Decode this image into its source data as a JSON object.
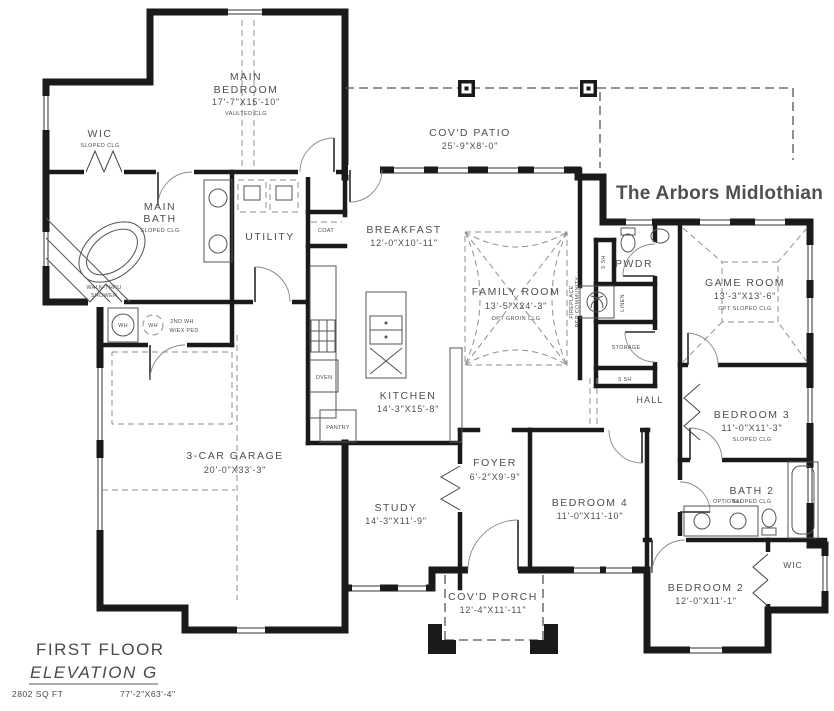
{
  "title": "The Arbors Midlothian",
  "colors": {
    "title": "#1d3d5e",
    "walls": "#1a1a1a",
    "labels": "#4f4f4f"
  },
  "footer": {
    "floor_label": "FIRST FLOOR",
    "elevation_label": "ELEVATION G",
    "area": "2802 SQ FT",
    "overall_dims": "77'-2\"X63'-4\""
  },
  "rooms": {
    "main_bedroom": {
      "name_line1": "MAIN",
      "name_line2": "BEDROOM",
      "dims": "17'-7\"X15'-10\"",
      "note": "VAULTED CLG"
    },
    "wic_main": {
      "name": "WIC",
      "note": "SLOPED CLG"
    },
    "main_bath": {
      "name_line1": "MAIN",
      "name_line2": "BATH",
      "note": "SLOPED CLG"
    },
    "covd_patio": {
      "name": "COV'D PATIO",
      "dims": "25'-9\"X8'-0\""
    },
    "breakfast": {
      "name": "BREAKFAST",
      "dims": "12'-0\"X10'-11\""
    },
    "family_room": {
      "name": "FAMILY ROOM",
      "dims": "13'-5\"X24'-3\"",
      "note": "OPT GROIN CLG"
    },
    "game_room": {
      "name": "GAME ROOM",
      "dims": "13'-3\"X13'-6\"",
      "note": "OPT SLOPED CLG"
    },
    "kitchen": {
      "name": "KITCHEN",
      "dims": "14'-3\"X15'-8\""
    },
    "utility": {
      "name": "UTILITY"
    },
    "pwdr": {
      "name": "PWDR"
    },
    "hall": {
      "name": "HALL"
    },
    "garage": {
      "name": "3-CAR GARAGE",
      "dims": "20'-0\"X33'-3\""
    },
    "study": {
      "name": "STUDY",
      "dims": "14'-3\"X11'-9\""
    },
    "foyer": {
      "name": "FOYER",
      "dims": "6'-2\"X9'-9\""
    },
    "bedroom4": {
      "name": "BEDROOM 4",
      "dims": "11'-0\"X11'-10\""
    },
    "bedroom3": {
      "name": "BEDROOM 3",
      "dims": "11'-0\"X11'-3\"",
      "note": "SLOPED CLG"
    },
    "bath2": {
      "name": "BATH 2",
      "note": "SLOPED CLG"
    },
    "bedroom2": {
      "name": "BEDROOM 2",
      "dims": "12'-0\"X11'-1\""
    },
    "wic_bedroom2": {
      "name": "WIC"
    },
    "covd_porch": {
      "name": "COV'D PORCH",
      "dims": "12'-4\"X11'-11\""
    }
  },
  "callouts": {
    "shower_line1": "WALK-THRU",
    "shower_line2": "SHOWER",
    "coat": "COAT",
    "oven": "OVEN",
    "pantry": "PANTRY",
    "linen": "LINEN",
    "storage": "STORAGE",
    "shelves_pwdr": "5 SH",
    "shelves_hall": "5 SH",
    "water_heater": "WH",
    "water_heater_2": "WH",
    "second_wh_line1": "2ND WH",
    "second_wh_line2": "W/EX PED",
    "fireplace_line1": "FIREPLACE",
    "fireplace_line2": "PER COMMUNITY",
    "optional": "OPTIONAL"
  }
}
